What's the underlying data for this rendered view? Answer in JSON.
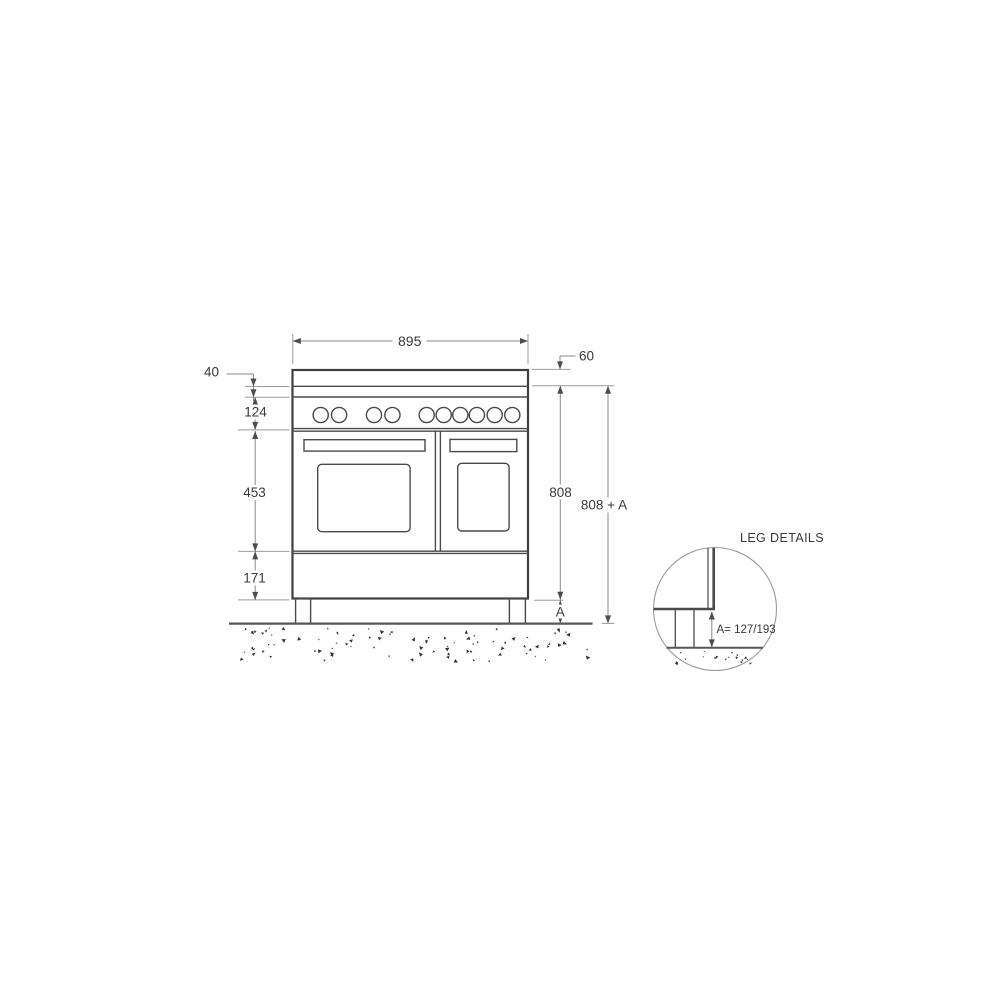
{
  "diagram": {
    "dimensions": {
      "overall_width": "895",
      "top_section_height": "60",
      "hob_trim_height": "40",
      "control_panel_height": "124",
      "oven_door_height": "453",
      "plinth_height": "171",
      "body_height": "808",
      "overall_height": "808 + A",
      "leg_height_label": "A"
    },
    "leg_detail": {
      "title": "LEG DETAILS",
      "leg_height_values": "A= 127/193"
    },
    "knob_count": 10,
    "colors": {
      "background": "#ffffff",
      "outline": "#3f3f3f",
      "dimension_lines": "#8a8a8a",
      "text": "#3a3a3a"
    }
  }
}
